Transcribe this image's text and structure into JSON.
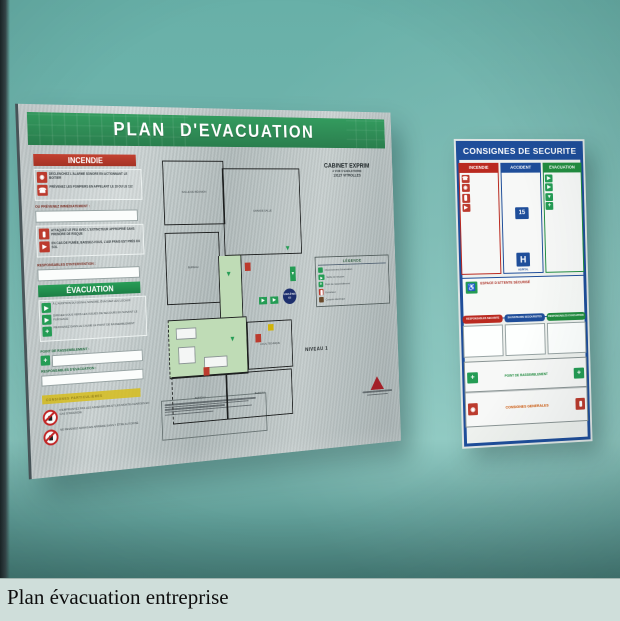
{
  "caption": {
    "text": "Plan évacuation entreprise"
  },
  "colors": {
    "wall_teal": "#6cb5ac",
    "caption_bg": "#cfdeda",
    "header_green": "#2f9c5c",
    "alert_red": "#c13a2c",
    "evac_green": "#1f9e52",
    "security_blue": "#1d4e9e",
    "metal_silver": "#c3cccc",
    "highlight_yellow": "#d6be1e"
  },
  "main_sign": {
    "title": "PLAN D'EVACUATION",
    "company": {
      "name": "CABINET EXPRIM",
      "address1": "4 VOIE D'ANGLETERRE",
      "address2": "13127 VITROLLES"
    },
    "level": "NIVEAU 1",
    "incendie": {
      "header": "INCENDIE",
      "rows": [
        {
          "icon": "alarm-button-icon",
          "text": "DÉCLENCHEZ L'ALARME SONORE EN ACTIONNANT LE BOITIER"
        },
        {
          "icon": "phone-icon",
          "text": "PRÉVENEZ LES POMPIERS EN APPELANT LE 18 OU LE 112"
        }
      ],
      "notify_label": "OU PRÉVENEZ IMMÉDIATEMENT :",
      "rows2": [
        {
          "icon": "extinguisher-icon",
          "text": "ATTAQUEZ LE FEU AVEC L'EXTINCTEUR APPROPRIÉ SANS PRENDRE DE RISQUE"
        },
        {
          "icon": "smoke-crawl-icon",
          "text": "EN CAS DE FUMÉE, BAISSEZ-VOUS, L'AIR FRAIS EST PRÈS DU SOL"
        }
      ],
      "responsables_label": "RESPONSABLES D'INTERVENTION :"
    },
    "evacuation": {
      "header": "ÉVACUATION",
      "rows": [
        {
          "icon": "exit-man-icon",
          "text": "À L'AUDITION DU SIGNAL SONORE, ÉVACUEZ LES LOCAUX"
        },
        {
          "icon": "route-icon",
          "text": "DIRIGEZ-VOUS VERS LES ISSUES DE SECOURS EN SUIVANT LE FLÉCHAGE"
        },
        {
          "icon": "assembly-icon",
          "text": "REJOIGNEZ DANS LE CALME LE POINT DE RASSEMBLEMENT"
        }
      ],
      "rally_label": "POINT DE RASSEMBLEMENT :",
      "responsables_label": "RESPONSABLES D'ÉVACUATION :"
    },
    "warnings": {
      "band_text": "CONSIGNES PARTICULIÈRES",
      "items": [
        {
          "icon": "no-elevator-icon",
          "text": "N'EMPRUNTEZ PAS LES ASCENSEURS ET LES MONTE-CHARGES EN CAS D'INCENDIE"
        },
        {
          "icon": "no-return-icon",
          "text": "NE REVENEZ JAMAIS EN ARRIÈRE SANS Y ÊTRE AUTORISÉ"
        }
      ]
    },
    "legend": {
      "title": "LÉGENDE",
      "items": [
        {
          "icon": "route-arrow-icon",
          "label": "Cheminement d'évacuation"
        },
        {
          "icon": "exit-door-icon",
          "label": "Sortie de secours"
        },
        {
          "icon": "assembly-point-icon",
          "label": "Point de rassemblement"
        },
        {
          "icon": "extinguisher-icon",
          "label": "Extincteur"
        },
        {
          "icon": "cutoff-icon",
          "label": "Coupure électrique"
        }
      ]
    },
    "plan": {
      "you_are_here": "VOUS ÊTES ICI",
      "rooms": [
        "SALLE DE RÉUNION",
        "GRANDE SALLE",
        "BUREAU",
        "LOCAL TECHNIQUE",
        "BUREAU",
        "BUREAU"
      ]
    }
  },
  "security_sign": {
    "title": "CONSIGNES DE SECURITE",
    "columns": [
      {
        "header": "INCENDIE"
      },
      {
        "header": "ACCIDENT"
      },
      {
        "header": "EVACUATION"
      }
    ],
    "accident": {
      "samu_number": "15",
      "hospital_letter": "H",
      "hospital_label": "HOPITAL"
    },
    "notice_title": "ESPACE D'ATTENTE SÉCURISÉ",
    "pills": [
      "RESPONSABLES SECURITE",
      "SAUVETEURS SECOURISTES",
      "RESPONSABLES EVACUATION"
    ],
    "rally_label": "POINT DE RASSEMBLEMENT",
    "general_title": "CONSIGNES GENERALES"
  }
}
